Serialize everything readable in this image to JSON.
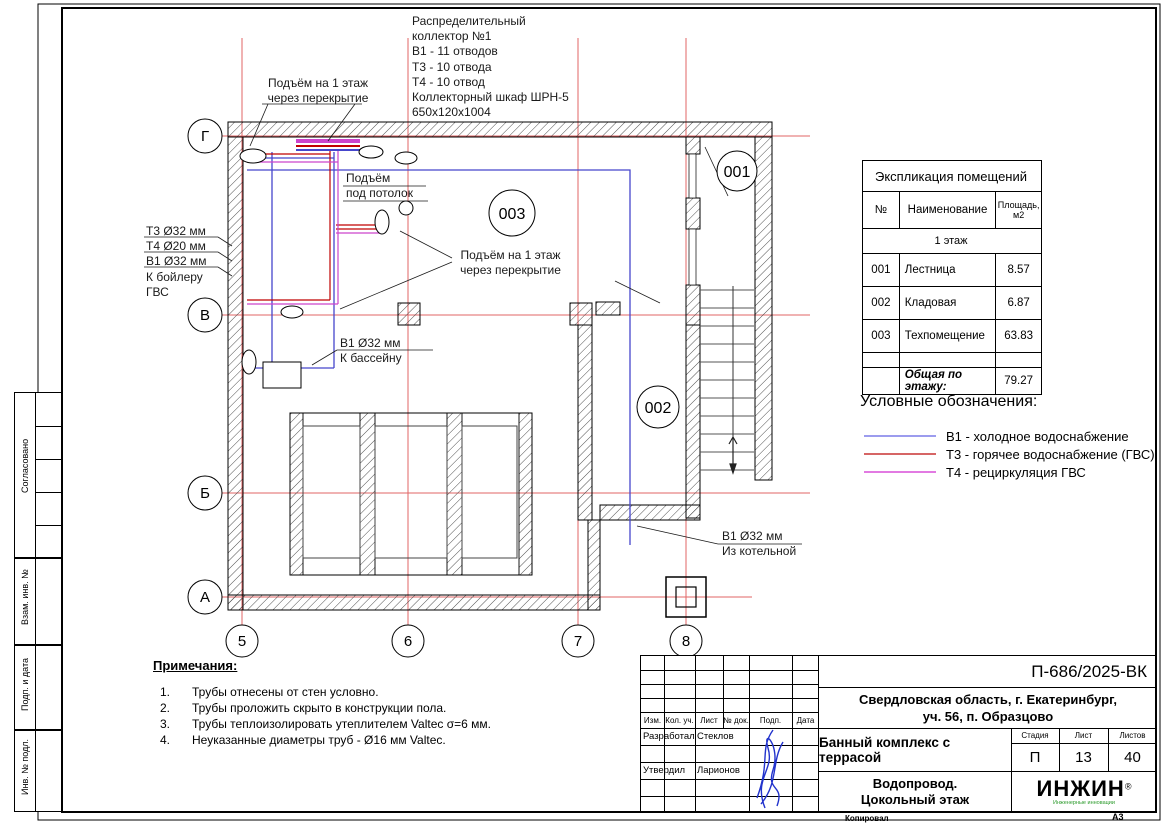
{
  "sheet": {
    "copied_label": "Копировал",
    "format_label": "А3"
  },
  "axes": {
    "rows": [
      "Г",
      "В",
      "Б",
      "А"
    ],
    "cols": [
      "5",
      "6",
      "7",
      "8"
    ]
  },
  "rooms": [
    "001",
    "002",
    "003"
  ],
  "labels": {
    "collector": "Распределительный\nколлектор №1\nВ1 - 11 отводов\nТ3 - 10 отвода\nТ4 - 10 отвод\nКоллекторный шкаф ШРН-5\n650x120x1004",
    "rise_top": "Подъём на 1 этаж\nчерез перекрытие",
    "rise_ceiling": "Подъём\nпод потолок",
    "rise_mid": "Подъём на 1 этаж\nчерез перекрытие",
    "t3": "Т3 Ø32 мм",
    "t4": "Т4 Ø20 мм",
    "b1": "В1 Ø32 мм",
    "boiler": "К бойлеру\nГВС",
    "pool": "В1 Ø32 мм\nК бассейну",
    "from_boiler": "В1 Ø32 мм\nИз котельной"
  },
  "explication": {
    "title": "Экспликация помещений",
    "col_no": "№",
    "col_name": "Наименование",
    "col_area": "Площадь,\nм2",
    "floor": "1 этаж",
    "rows": [
      [
        "001",
        "Лестница",
        "8.57"
      ],
      [
        "002",
        "Кладовая",
        "6.87"
      ],
      [
        "003",
        "Техпомещение",
        "63.83"
      ]
    ],
    "total_label": "Общая по этажу:",
    "total_value": "79.27"
  },
  "legend": {
    "title": "Условные обозначения:",
    "items": [
      {
        "color": "#7b7be8",
        "label": "В1 - холодное водоснабжение"
      },
      {
        "color": "#c83232",
        "label": "Т3 - горячее водоснабжение (ГВС)"
      },
      {
        "color": "#d84fd8",
        "label": "Т4 - рециркуляция ГВС"
      }
    ]
  },
  "notes": {
    "title": "Примечания:",
    "items": [
      {
        "num": "1.",
        "text": "Трубы отнесены от стен условно."
      },
      {
        "num": "2.",
        "text": "Трубы проложить скрыто в конструкции пола."
      },
      {
        "num": "3.",
        "text": "Трубы теплоизолировать утеплителем Valtec σ=6 мм."
      },
      {
        "num": "4.",
        "text": "Неуказанные диаметры труб - Ø16 мм Valtec."
      }
    ]
  },
  "title_block": {
    "doc_number": "П-686/2025-ВК",
    "location": "Свердловская область, г. Екатеринбург,\nуч. 56, п. Образцово",
    "project": "Банный комплекс с террасой",
    "sheet_title": "Водопровод.\nЦокольный этаж",
    "cols": [
      "Изм.",
      "Кол. уч.",
      "Лист",
      "№ док.",
      "Подп.",
      "Дата"
    ],
    "stage_label": "Стадия",
    "sheet_label": "Лист",
    "sheets_label": "Листов",
    "stage": "П",
    "sheet_no": "13",
    "sheets_total": "40",
    "role_1": "Разработал",
    "name_1": "Стеклов",
    "role_2": "Утвердил",
    "name_2": "Ларионов",
    "logo_text": "ИНЖИН",
    "logo_reg": "®",
    "logo_sub": "Инженерные инновации"
  },
  "side_stamp": [
    "Согласовано",
    "Взам. инв. №",
    "Подп. и дата",
    "Инв. № подл."
  ]
}
